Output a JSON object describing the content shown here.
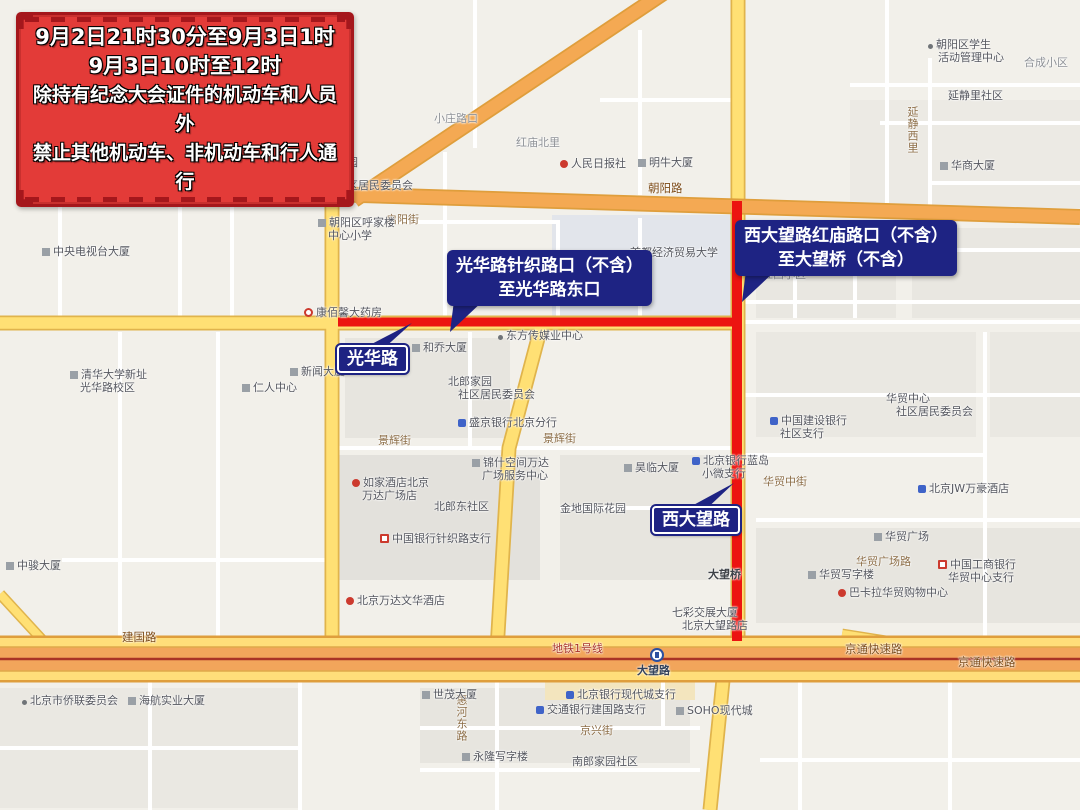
{
  "colors": {
    "callout_navy": "#1E2383",
    "route_red": "#EC1410",
    "banner_red": "#E33B38",
    "banner_border": "#A5171C",
    "road_yellow": "#FFE074",
    "road_orange": "#F4A953",
    "metro_red": "#A93226"
  },
  "banner": {
    "lines": [
      "9月2日21时30分至9月3日1时",
      "9月3日10时至12时",
      "除持有纪念大会证件的机动车和人员外",
      "禁止其他机动车、非机动车和行人通行"
    ]
  },
  "callouts": [
    {
      "lines": [
        "光华路针织路口（不含）",
        "至光华路东口"
      ]
    },
    {
      "lines": [
        "西大望路红庙路口（不含）",
        "至大望桥（不含）"
      ]
    }
  ],
  "road_badges": [
    {
      "text": "光华路"
    },
    {
      "text": "西大望路"
    }
  ],
  "station": {
    "name": "大望路"
  },
  "labels": [
    {
      "t": "朝阳路",
      "x": 648,
      "y": 182,
      "c": "hwy"
    },
    {
      "t": "建国路",
      "x": 122,
      "y": 631,
      "c": "hwy"
    },
    {
      "t": "京通快速路",
      "x": 845,
      "y": 643,
      "c": "hwy"
    },
    {
      "t": "京通快速路",
      "x": 958,
      "y": 656,
      "c": "hwy"
    },
    {
      "t": "地铁1号线",
      "x": 552,
      "y": 642,
      "c": "metro"
    },
    {
      "t": "启阳街",
      "x": 386,
      "y": 213,
      "c": "street"
    },
    {
      "t": "景辉街",
      "x": 378,
      "y": 434,
      "c": "street"
    },
    {
      "t": "景辉街",
      "x": 543,
      "y": 432,
      "c": "street"
    },
    {
      "t": "华贸中街",
      "x": 763,
      "y": 475,
      "c": "street"
    },
    {
      "t": "华贸广场路",
      "x": 856,
      "y": 555,
      "c": "street"
    },
    {
      "t": "京兴街",
      "x": 580,
      "y": 724,
      "c": "street"
    },
    {
      "t": "惠河东路",
      "x": 455,
      "y": 694,
      "c": "street",
      "v": 1
    },
    {
      "t": "延静西里",
      "x": 906,
      "y": 106,
      "c": "street",
      "v": 1
    },
    {
      "t": "大望桥",
      "x": 708,
      "y": 568,
      "c": "dark"
    },
    {
      "t": "朝阳区新世纪幼儿园",
      "x": 248,
      "y": 156,
      "ic": "g"
    },
    {
      "t": "新街社区居民委员会",
      "x": 306,
      "y": 179,
      "ic": "d"
    },
    {
      "t": "新街大院",
      "x": 258,
      "y": 186,
      "c": "poi2"
    },
    {
      "ls": [
        "朝阳区呼家楼",
        "中心小学"
      ],
      "x": 318,
      "y": 216,
      "ic": "g"
    },
    {
      "t": "人民日报社",
      "x": 560,
      "y": 157,
      "ic": "r"
    },
    {
      "t": "明牛大厦",
      "x": 638,
      "y": 156,
      "ic": "g"
    },
    {
      "ls": [
        "朝阳区学生",
        "活动管理中心"
      ],
      "x": 928,
      "y": 38,
      "ic": "d"
    },
    {
      "t": "合成小区",
      "x": 1024,
      "y": 56,
      "c": "poi2"
    },
    {
      "t": "延静里社区",
      "x": 948,
      "y": 89
    },
    {
      "t": "华商大厦",
      "x": 940,
      "y": 159,
      "ic": "g"
    },
    {
      "t": "红庙北里",
      "x": 516,
      "y": 136,
      "c": "poi2"
    },
    {
      "t": "小庄路口",
      "x": 434,
      "y": 112,
      "c": "poi2"
    },
    {
      "t": "首都经济贸易大学",
      "x": 630,
      "y": 246
    },
    {
      "t": "红西小区",
      "x": 762,
      "y": 268,
      "c": "poi2"
    },
    {
      "t": "中央电视台大厦",
      "x": 42,
      "y": 245,
      "ic": "g"
    },
    {
      "ls": [
        "清华大学新址",
        "光华路校区"
      ],
      "x": 70,
      "y": 368,
      "ic": "g"
    },
    {
      "t": "康佰馨大药房",
      "x": 304,
      "y": 306,
      "ic": "o"
    },
    {
      "t": "和乔大厦",
      "x": 412,
      "y": 341,
      "ic": "g"
    },
    {
      "t": "新闻大厦",
      "x": 290,
      "y": 365,
      "ic": "g"
    },
    {
      "t": "仁人中心",
      "x": 242,
      "y": 381,
      "ic": "g"
    },
    {
      "t": "东方传媒业中心",
      "x": 498,
      "y": 329,
      "ic": "d"
    },
    {
      "ls": [
        "北郎家园",
        "社区居民委员会"
      ],
      "x": 448,
      "y": 375
    },
    {
      "t": "盛京银行北京分行",
      "x": 458,
      "y": 416,
      "ic": "b"
    },
    {
      "ls": [
        "锦什空间万达",
        "广场服务中心"
      ],
      "x": 472,
      "y": 456,
      "ic": "g"
    },
    {
      "ls": [
        "如家酒店北京",
        "万达广场店"
      ],
      "x": 352,
      "y": 476,
      "ic": "r"
    },
    {
      "t": "北郎东社区",
      "x": 434,
      "y": 500
    },
    {
      "t": "金地国际花园",
      "x": 560,
      "y": 502
    },
    {
      "t": "中国银行针织路支行",
      "x": 380,
      "y": 532,
      "ic": "rb"
    },
    {
      "t": "昊临大厦",
      "x": 624,
      "y": 461,
      "ic": "g"
    },
    {
      "ls": [
        "北京银行蓝岛",
        "小微支行"
      ],
      "x": 692,
      "y": 454,
      "ic": "b"
    },
    {
      "ls": [
        "中国建设银行",
        "社区支行"
      ],
      "x": 770,
      "y": 414,
      "ic": "b"
    },
    {
      "ls": [
        "华贸中心",
        "社区居民委员会"
      ],
      "x": 886,
      "y": 392
    },
    {
      "t": "北京JW万豪酒店",
      "x": 918,
      "y": 482,
      "ic": "b"
    },
    {
      "t": "华贸广场",
      "x": 874,
      "y": 530,
      "ic": "g"
    },
    {
      "ls": [
        "中国工商银行",
        "华贸中心支行"
      ],
      "x": 938,
      "y": 558,
      "ic": "rb"
    },
    {
      "t": "华贸写字楼",
      "x": 808,
      "y": 568,
      "ic": "g"
    },
    {
      "t": "巴卡拉华贸购物中心",
      "x": 838,
      "y": 586,
      "ic": "r"
    },
    {
      "ls": [
        "七彩交展大厦",
        "北京大望路店"
      ],
      "x": 672,
      "y": 606
    },
    {
      "t": "北京万达文华酒店",
      "x": 346,
      "y": 594,
      "ic": "r"
    },
    {
      "t": "中骏大厦",
      "x": 6,
      "y": 559,
      "ic": "g"
    },
    {
      "t": "北京市侨联委员会",
      "x": 22,
      "y": 694,
      "ic": "d"
    },
    {
      "t": "海航实业大厦",
      "x": 128,
      "y": 694,
      "ic": "g"
    },
    {
      "t": "世茂大厦",
      "x": 422,
      "y": 688,
      "ic": "g"
    },
    {
      "t": "北京银行现代城支行",
      "x": 566,
      "y": 688,
      "ic": "b"
    },
    {
      "t": "交通银行建国路支行",
      "x": 536,
      "y": 703,
      "ic": "b"
    },
    {
      "t": "SOHO现代城",
      "x": 676,
      "y": 704,
      "ic": "g"
    },
    {
      "t": "永隆写字楼",
      "x": 462,
      "y": 750,
      "ic": "g"
    },
    {
      "t": "南郎家园社区",
      "x": 572,
      "y": 755
    }
  ]
}
